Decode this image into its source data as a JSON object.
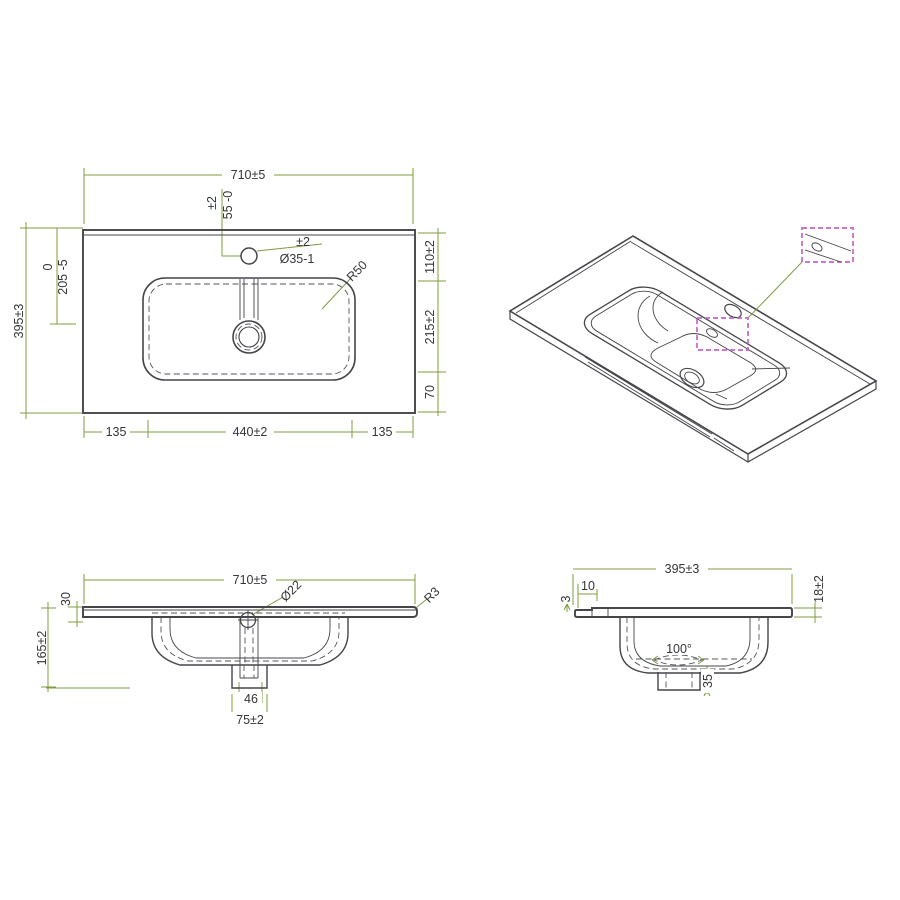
{
  "drawing": {
    "dimension_line_color": "#7d9c3f",
    "object_line_color": "#45454a",
    "callout_color": "#c565c5"
  },
  "plan": {
    "width": "710±5",
    "depth": "395±3",
    "center_offset_tol": "0",
    "center_offset": "205 -5",
    "hole_offset_tol": "±2",
    "hole_offset": "55 -0",
    "hole_dia_tol": "±2",
    "hole_dia": "Ø35-1",
    "corner_radius": "R50",
    "right_top": "110±2",
    "right_mid": "215±2",
    "right_bottom": "70",
    "bottom_left": "135",
    "bottom_mid": "440±2",
    "bottom_right": "135"
  },
  "front": {
    "width": "710±5",
    "edge_height": "30",
    "total_height": "165±2",
    "overflow_dia": "Ø22",
    "edge_radius": "R3",
    "drain_inner": "46",
    "drain_outer": "75±2"
  },
  "side": {
    "depth": "395±3",
    "front_strip": "10",
    "front_drop": "3",
    "edge_thickness": "18±2",
    "cone_angle": "100°",
    "drain_height": "35"
  }
}
